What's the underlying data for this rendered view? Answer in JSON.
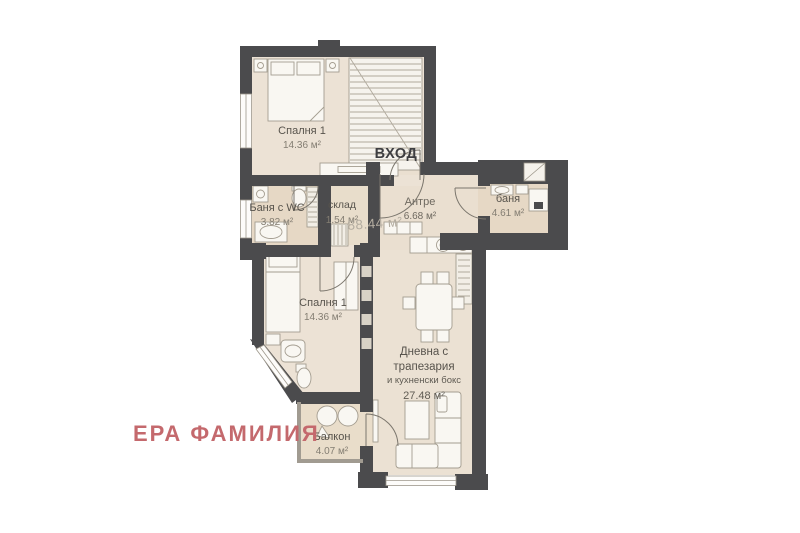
{
  "plan": {
    "entrance_label": "ВХОД",
    "total_area": "88.44 м²",
    "watermark": {
      "text": "ЕРА ФАМИЛИЯ",
      "color": "#c4696d"
    },
    "rooms": {
      "bedroom1": {
        "name": "Спалня 1",
        "area": "14.36 м²"
      },
      "banya_wc": {
        "name": "Баня с WC",
        "area": "3.82 м²"
      },
      "sklad": {
        "name": "склад",
        "area": "1.54 м²"
      },
      "antre": {
        "name": "Антре",
        "area": "6.68 м²"
      },
      "banya": {
        "name": "баня",
        "area": "4.61 м²"
      },
      "bedroom2": {
        "name": "Спалня 1",
        "area": "14.36 м²"
      },
      "living": {
        "name_line1": "Дневна с",
        "name_line2": "трапезария",
        "name_line3": "и кухненски бокс",
        "area": "27.48 м²"
      },
      "balcony": {
        "name": "Балкон",
        "area": "4.07 м²"
      }
    },
    "colors": {
      "wall": "#4b4b4d",
      "floor": "#ece2d5",
      "floor_wet": "#e6d8c5",
      "furniture_stroke": "#a49d90",
      "label_text": "#57534c",
      "total_area_text": "#b3aca0",
      "watermark": "#c4696d"
    }
  }
}
